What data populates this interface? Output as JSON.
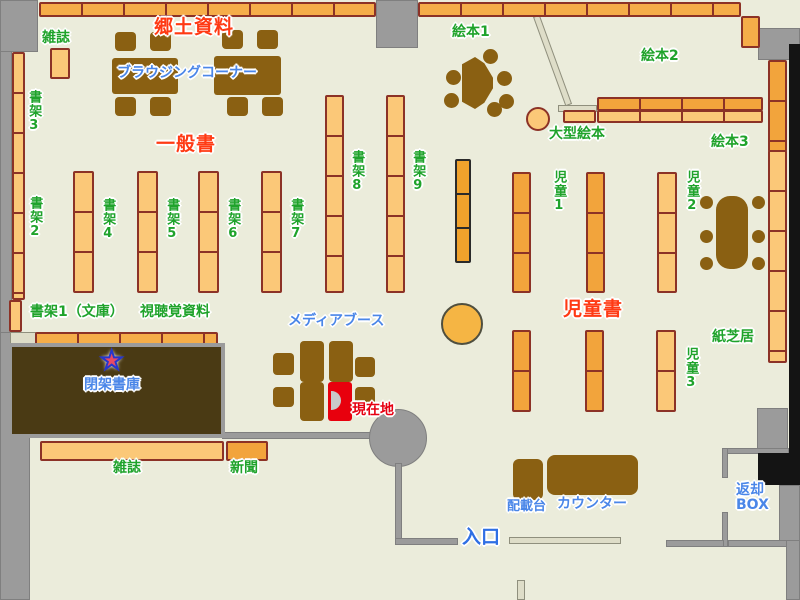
{
  "map_title": "library-floor-map",
  "colors": {
    "floor": "#EBECDB",
    "wall_gray": "#9B9B9B",
    "wall_black": "#141414",
    "shelf_light_orange": "#FBC878",
    "shelf_dark_orange": "#F2A43C",
    "shelf_border_maroon": "#8C3226",
    "furniture_brown": "#8A6012",
    "closed_stacks_brown": "#4A3A14",
    "partition_beige": "#DEDDC8",
    "label_green": "#1FA32B",
    "label_red": "#FF3A14",
    "label_blue": "#4A86E8",
    "current_location_red": "#E60012",
    "booth_red": "#E8000D"
  },
  "labels": {
    "magazines_top": "雑誌",
    "local_materials": "郷土資料",
    "browsing_corner": "ブラウジングコーナー",
    "shelf3": "書架3",
    "general_books": "一般書",
    "shelf2": "書架2",
    "shelf4": "書架4",
    "shelf5": "書架5",
    "shelf6": "書架6",
    "shelf7": "書架7",
    "shelf8": "書架8",
    "shelf9": "書架9",
    "picture_books1": "絵本1",
    "picture_books2": "絵本2",
    "picture_books3": "絵本3",
    "large_picture_books": "大型絵本",
    "children1": "児童1",
    "children2": "児童2",
    "children3": "児童3",
    "children_books": "児童書",
    "kamishibai": "紙芝居",
    "shelf1_bunko": "書架1（文庫）",
    "audiovisual": "視聴覚資料",
    "media_booth": "メディアブース",
    "closed_stacks": "閉架書庫",
    "current_location": "現在地",
    "magazines_bottom": "雑誌",
    "newspapers": "新聞",
    "sorting_desk": "配載台",
    "counter": "カウンター",
    "return_box_line1": "返却",
    "return_box_line2": "BOX",
    "entrance": "入口"
  },
  "icons": {
    "star": "★"
  }
}
